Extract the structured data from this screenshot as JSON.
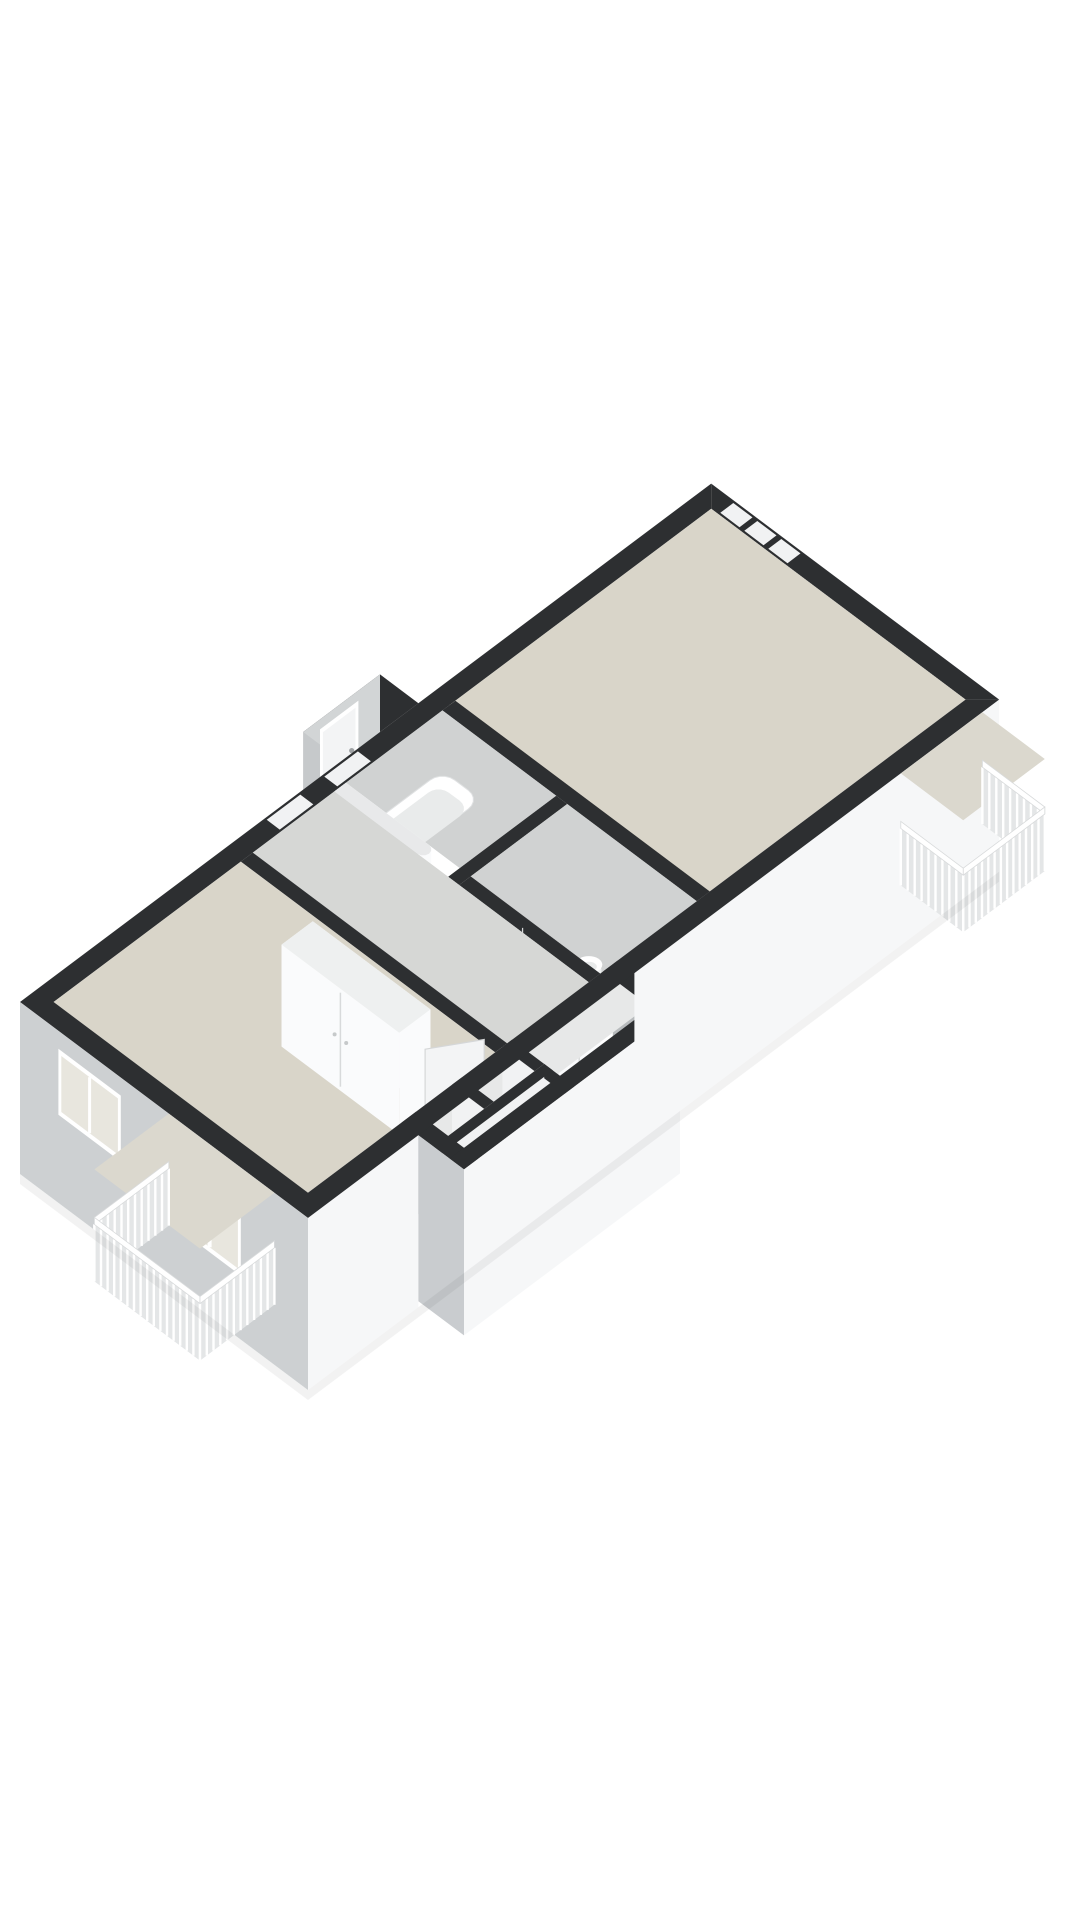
{
  "scene": {
    "type": "floorplan-3d-axonometric",
    "description": "Cut-away 3D floor plan of an apartment viewed from the south, no text labels",
    "background": "#ffffff",
    "wall_height_px": 104,
    "facade_depth_px": 172,
    "axis": {
      "ux": 48,
      "uy": -36,
      "vx": 48,
      "vy": 36,
      "ox": 20,
      "oy": 1002
    }
  },
  "palette": {
    "wallTop": "#2d2f31",
    "white": "#fafbfc",
    "white2": "#f1f2f3",
    "greyIn": "#c7cacc",
    "greyDark": "#b7babc",
    "greyMid": "#d3d5d6",
    "facadeSW": "#cdd0d2",
    "facadeSE": "#f6f7f8",
    "facadeEnd": "#c9cccf",
    "bumpFace": "#d2d5d6",
    "bumpEnd": "#c6c9cb",
    "floorBeige": "#d9d5c9",
    "floorGrey": "#d6d7d5",
    "floorBath": "#d0d2d2",
    "floorCell": "#e7e8e8",
    "balconyFloor": "#dbd8ce",
    "railBase": "#e4e6e7",
    "glass": "#e8e6de",
    "glassCool": "#eceeee",
    "frame": "#ffffff",
    "frameEdge": "#d6d8d9",
    "fixture": "#ffffff",
    "fixtureIn": "#e9ebeb",
    "fixtureSide": "#eef0f0",
    "doorPanel": "#f3f4f5",
    "seam": "#d8dadb",
    "throughDoor": "#e6e4da",
    "throughDoor2": "#dfe0de",
    "roundedWallTop": "#e8e9ea",
    "shadow": "#000000"
  },
  "building": {
    "length_m": 14.4,
    "width_m": 6.0,
    "wall_thickness_m": 0.35,
    "protrusion_se": [
      2.3,
      6.0,
      6.8,
      6.95
    ],
    "vestibule_nw": [
      6.7,
      -0.8,
      8.3,
      0
    ]
  },
  "rooms": [
    {
      "id": "living-room",
      "floor": "floorBeige",
      "bounds": [
        8.6,
        0.35,
        14.05,
        5.65
      ]
    },
    {
      "id": "bedroom",
      "floor": "floorBeige",
      "bounds": [
        0.35,
        0.35,
        4.25,
        5.65
      ]
    },
    {
      "id": "hall",
      "floor": "floorGrey",
      "bounds": [
        4.5,
        0.35,
        6.2,
        5.65
      ]
    },
    {
      "id": "bathroom",
      "floor": "floorBath",
      "bounds": [
        6.44,
        0.35,
        8.45,
        2.72
      ]
    },
    {
      "id": "toilet-room",
      "floor": "floorBath",
      "bounds": [
        6.44,
        2.95,
        8.45,
        5.65
      ]
    },
    {
      "id": "storage-cells",
      "floor": "floorCell",
      "bounds": [
        2.45,
        5.9,
        4.4,
        6.6
      ]
    },
    {
      "id": "closet-room",
      "floor": "floorCell",
      "bounds": [
        4.6,
        5.9,
        6.5,
        6.6
      ]
    },
    {
      "id": "vestibule",
      "floor": "floorGrey",
      "bounds": [
        6.85,
        -0.65,
        8.15,
        0
      ]
    },
    {
      "id": "balcony-east",
      "floor": "balconyFloor",
      "bounds": [
        12.35,
        6.0,
        14.05,
        7.3
      ]
    },
    {
      "id": "balcony-south",
      "floor": "balconyFloor",
      "bounds": [
        -1.55,
        3.1,
        0,
        5.3
      ]
    }
  ],
  "interior_walls": [
    {
      "id": "divider-living",
      "rect": [
        8.45,
        0.35,
        8.72,
        5.65
      ],
      "door_v": [
        0.95,
        1.85
      ]
    },
    {
      "id": "wall-bath-se",
      "rect": [
        6.2,
        2.72,
        8.45,
        2.95
      ]
    },
    {
      "id": "wall-bath-west",
      "rect": [
        6.2,
        0.35,
        6.44,
        2.2
      ],
      "rounded_end": true
    },
    {
      "id": "wall-wc-west",
      "rect": [
        6.2,
        2.95,
        6.44,
        5.65
      ],
      "door_v": [
        3.4,
        4.15
      ]
    },
    {
      "id": "wall-bedroom-east",
      "rect": [
        4.25,
        0.35,
        4.5,
        5.65
      ],
      "door_v": [
        4.5,
        5.3
      ]
    },
    {
      "id": "cell-divider-1",
      "rect": [
        3.35,
        5.65,
        3.55,
        6.95
      ]
    },
    {
      "id": "cell-divider-2",
      "rect": [
        4.4,
        5.65,
        4.6,
        6.95
      ]
    },
    {
      "id": "cell-cross",
      "rect": [
        2.3,
        6.32,
        4.6,
        6.5
      ]
    }
  ],
  "windows": [
    {
      "id": "bedroom-window-nw",
      "wall": "nw",
      "range": [
        1.2,
        2.8
      ],
      "dz": [
        4,
        52
      ],
      "mullion": true
    },
    {
      "id": "clerestory-1",
      "wall": "nw",
      "range": [
        5.1,
        5.8
      ],
      "dz": [
        0,
        26
      ],
      "band_gap": true
    },
    {
      "id": "clerestory-2",
      "wall": "nw",
      "range": [
        6.3,
        7.0
      ],
      "dz": [
        0,
        26
      ],
      "band_gap": true
    },
    {
      "id": "transom-1",
      "wall": "nw",
      "range": [
        9.4,
        9.9
      ],
      "dz": [
        8,
        40
      ]
    },
    {
      "id": "transom-2",
      "wall": "nw",
      "range": [
        10.5,
        11.0
      ],
      "dz": [
        8,
        40
      ]
    },
    {
      "id": "transom-3",
      "wall": "nw",
      "range": [
        11.6,
        12.1
      ],
      "dz": [
        8,
        40
      ]
    },
    {
      "id": "picture-window-ne",
      "wall": "ne",
      "range": [
        0.9,
        2.2
      ],
      "dz": [
        14,
        78
      ],
      "mullion": true
    },
    {
      "id": "french-doors-ne",
      "wall": "ne",
      "range": [
        2.35,
        3.75
      ],
      "dz": [
        6,
        102
      ],
      "double": true
    },
    {
      "id": "sidelight-1",
      "wall": "ne",
      "range": [
        3.9,
        4.45
      ],
      "dz": [
        6,
        102
      ]
    },
    {
      "id": "sidelight-2",
      "wall": "ne",
      "range": [
        4.55,
        5.1
      ],
      "dz": [
        6,
        102
      ]
    },
    {
      "id": "balcony-door-se",
      "wall": "se-inner",
      "range": [
        12.5,
        13.5
      ],
      "dz": [
        6,
        102
      ],
      "double": true
    },
    {
      "id": "bedroom-window-sw",
      "wall": "sw",
      "range": [
        0.8,
        2.1
      ],
      "dz": [
        18,
        84
      ],
      "mullion": true
    },
    {
      "id": "balcony-doors-sw",
      "wall": "sw",
      "range": [
        3.3,
        4.6
      ],
      "dz": [
        8,
        108
      ],
      "double": true
    },
    {
      "id": "front-door",
      "wall": "vestibule-nw",
      "range": [
        7.05,
        7.85
      ],
      "dz": [
        10,
        96
      ]
    }
  ],
  "ne_band_gaps": [
    [
      0.5,
      0.9
    ],
    [
      1.0,
      1.4
    ],
    [
      1.5,
      1.9
    ]
  ],
  "fixtures": [
    {
      "id": "bathtub",
      "rect": [
        6.55,
        0.55,
        8.25,
        1.35
      ]
    },
    {
      "id": "toilet",
      "pos": [
        6.95,
        3.5
      ]
    },
    {
      "id": "washbasin",
      "pos": [
        7.25,
        4.6
      ]
    },
    {
      "id": "wardrobe-bedroom",
      "rect": [
        3.55,
        1.9,
        4.2,
        4.35
      ]
    },
    {
      "id": "wardrobe-row",
      "rect": [
        4.65,
        5.65,
        6.45,
        6.2
      ],
      "doors": 4
    },
    {
      "id": "door-panel-bedroom",
      "hinge": [
        4.37,
        5.3
      ],
      "end": [
        3.62,
        4.82
      ]
    },
    {
      "id": "door-panel-toilet",
      "hinge": [
        6.32,
        4.15
      ],
      "end": [
        5.72,
        4.72
      ]
    }
  ],
  "railing": {
    "step_m": 0.13,
    "top_dz": 48,
    "slat_top_dz": 55,
    "floor_dz": 112
  }
}
